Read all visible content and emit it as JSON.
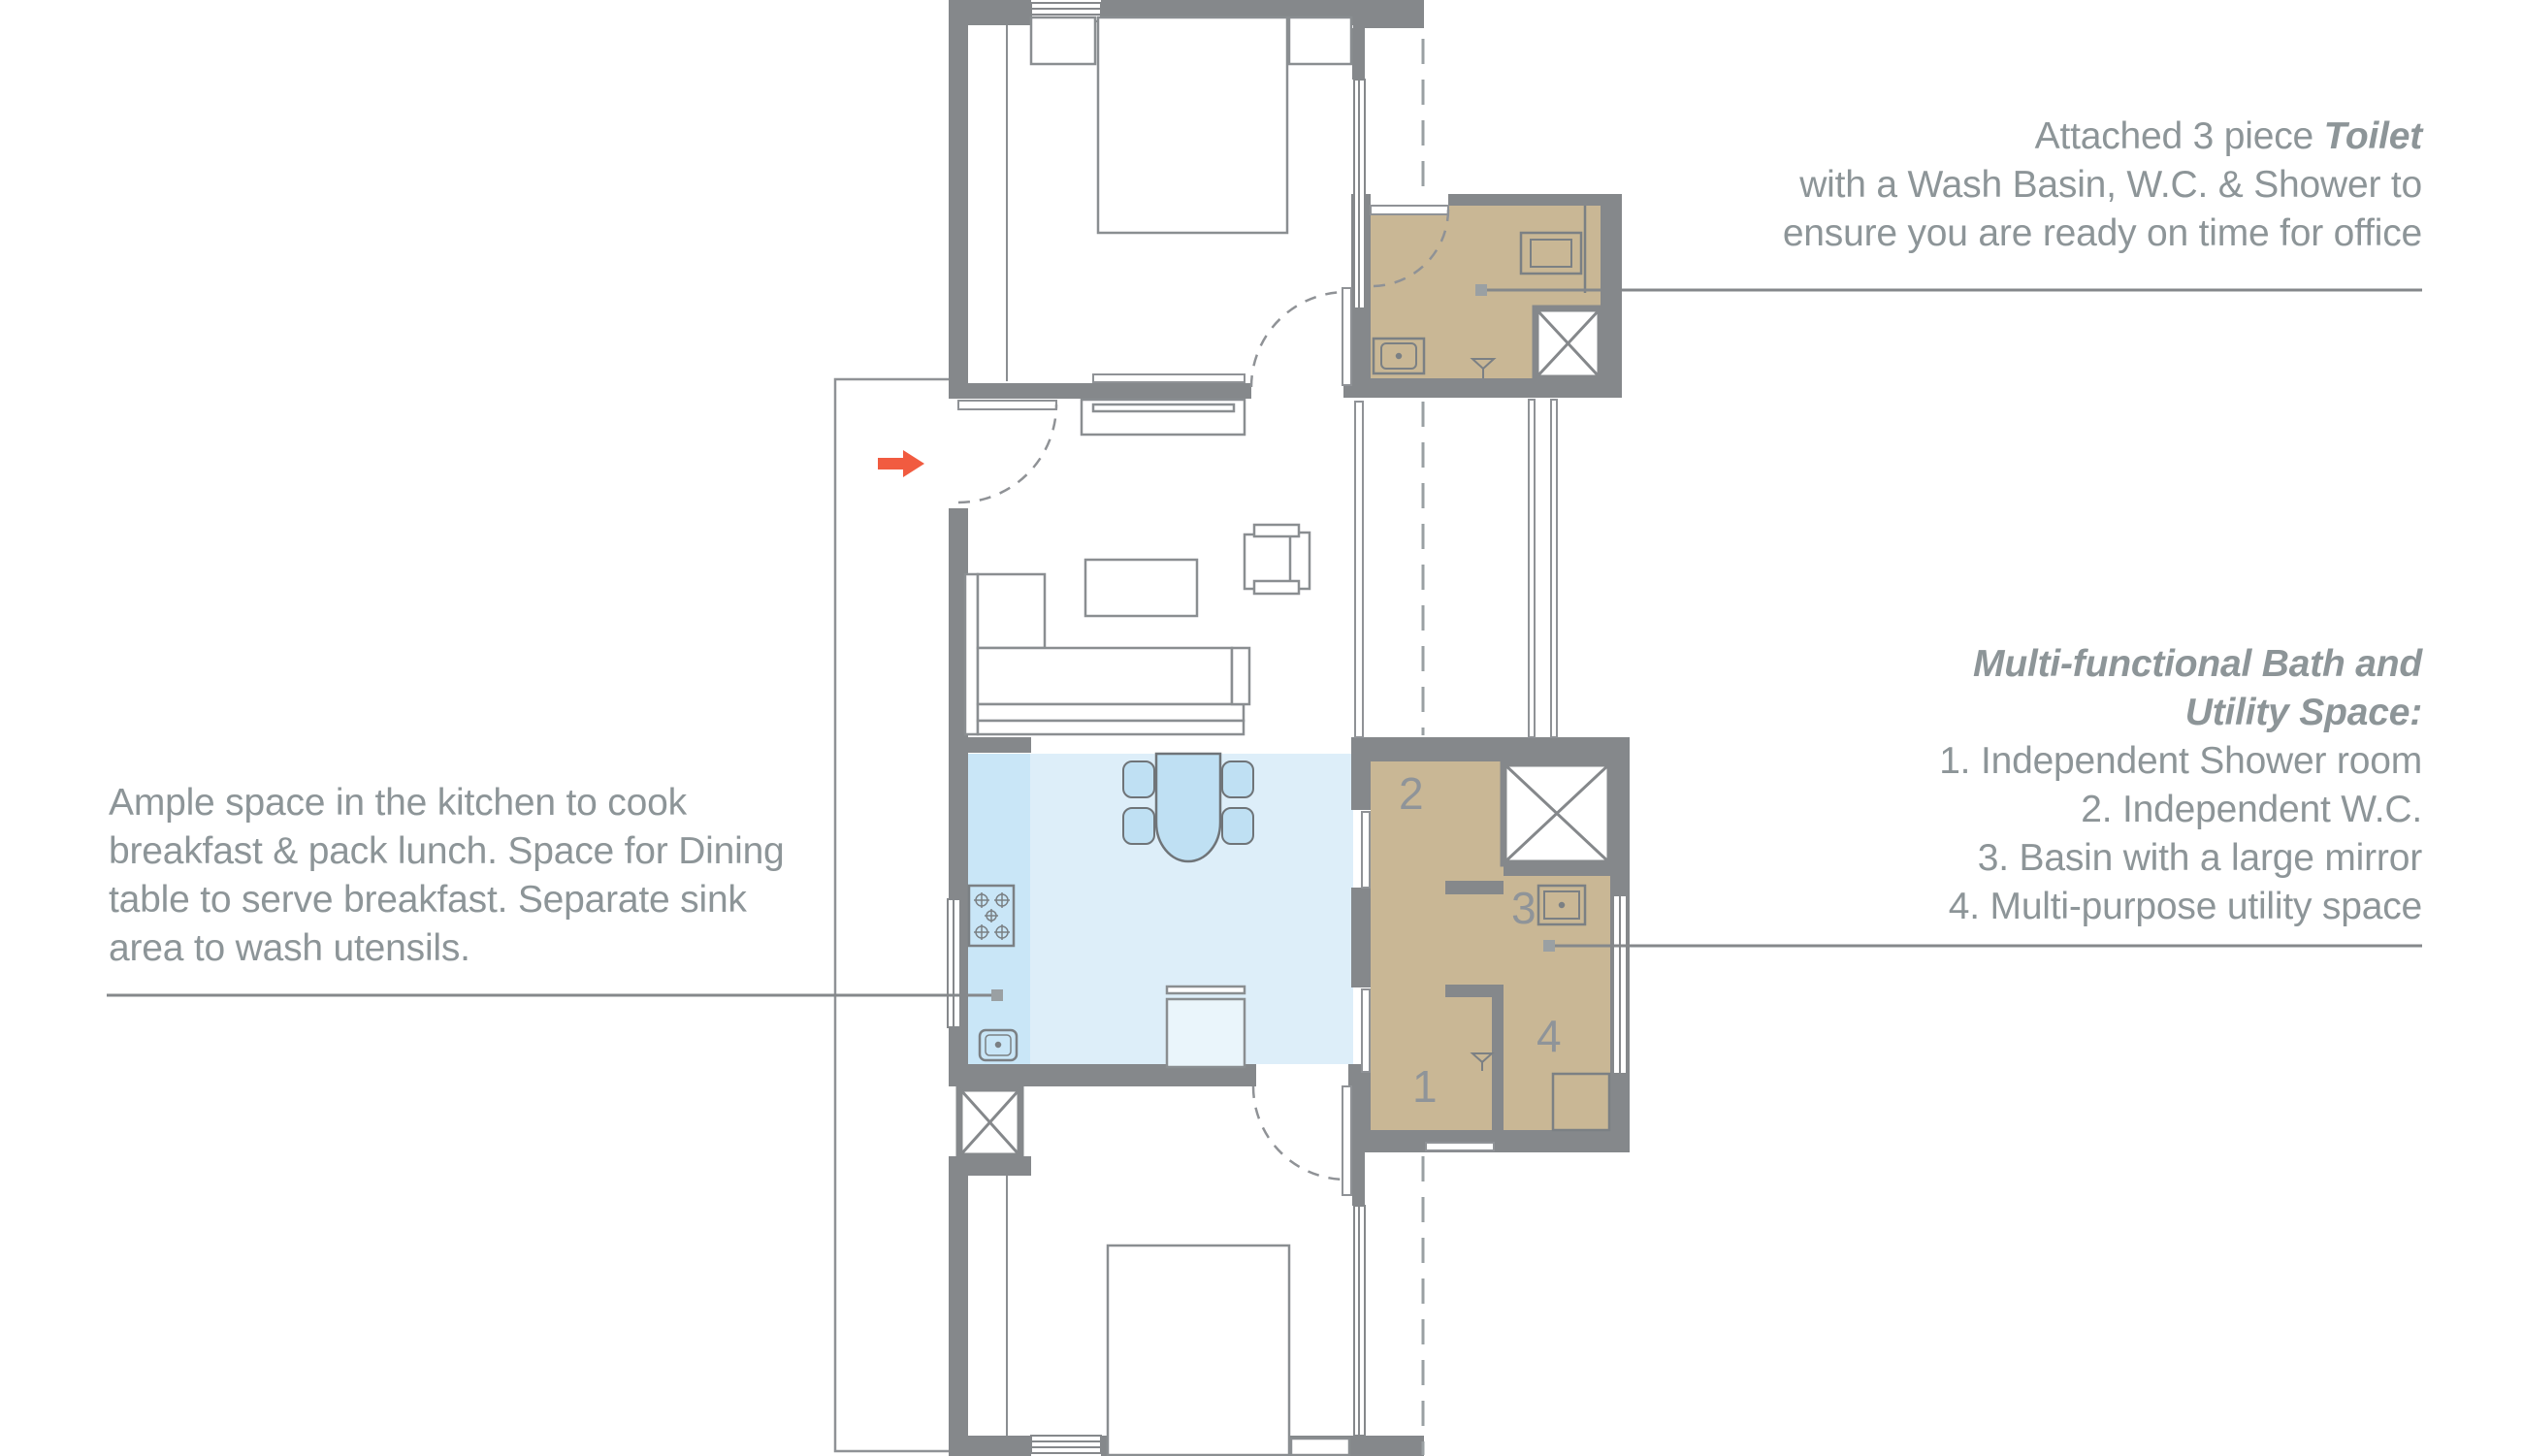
{
  "annotations": {
    "toilet_note": {
      "line1_regular": "Attached 3 piece ",
      "line1_bold": "Toilet",
      "line2": "with a Wash Basin, W.C. & Shower to",
      "line3": "ensure you are ready on time for office"
    },
    "bath_note": {
      "title_line1": "Multi-functional Bath and",
      "title_line2": "Utility Space:",
      "items": [
        "1. Independent Shower room",
        "2. Independent W.C.",
        "3. Basin with a large mirror",
        "4. Multi-purpose utility space"
      ]
    },
    "kitchen_note": {
      "line1": "Ample space in the kitchen to cook",
      "line2": "breakfast & pack lunch. Space for Dining",
      "line3": "table to serve breakfast. Separate sink",
      "line4": "area to wash utensils."
    }
  },
  "plan": {
    "room_numbers": {
      "shower_room": "1",
      "wc": "2",
      "basin": "3",
      "utility": "4"
    }
  },
  "colors": {
    "accent_arrow": "#F15B40",
    "bath_fill": "#C9B795",
    "kitchen_floor": "#DDEEF9",
    "kitchen_counter": "#C9E6F7",
    "furniture_blue": "#BFE0F3",
    "wall": "#85888B",
    "text": "#8D9598"
  }
}
